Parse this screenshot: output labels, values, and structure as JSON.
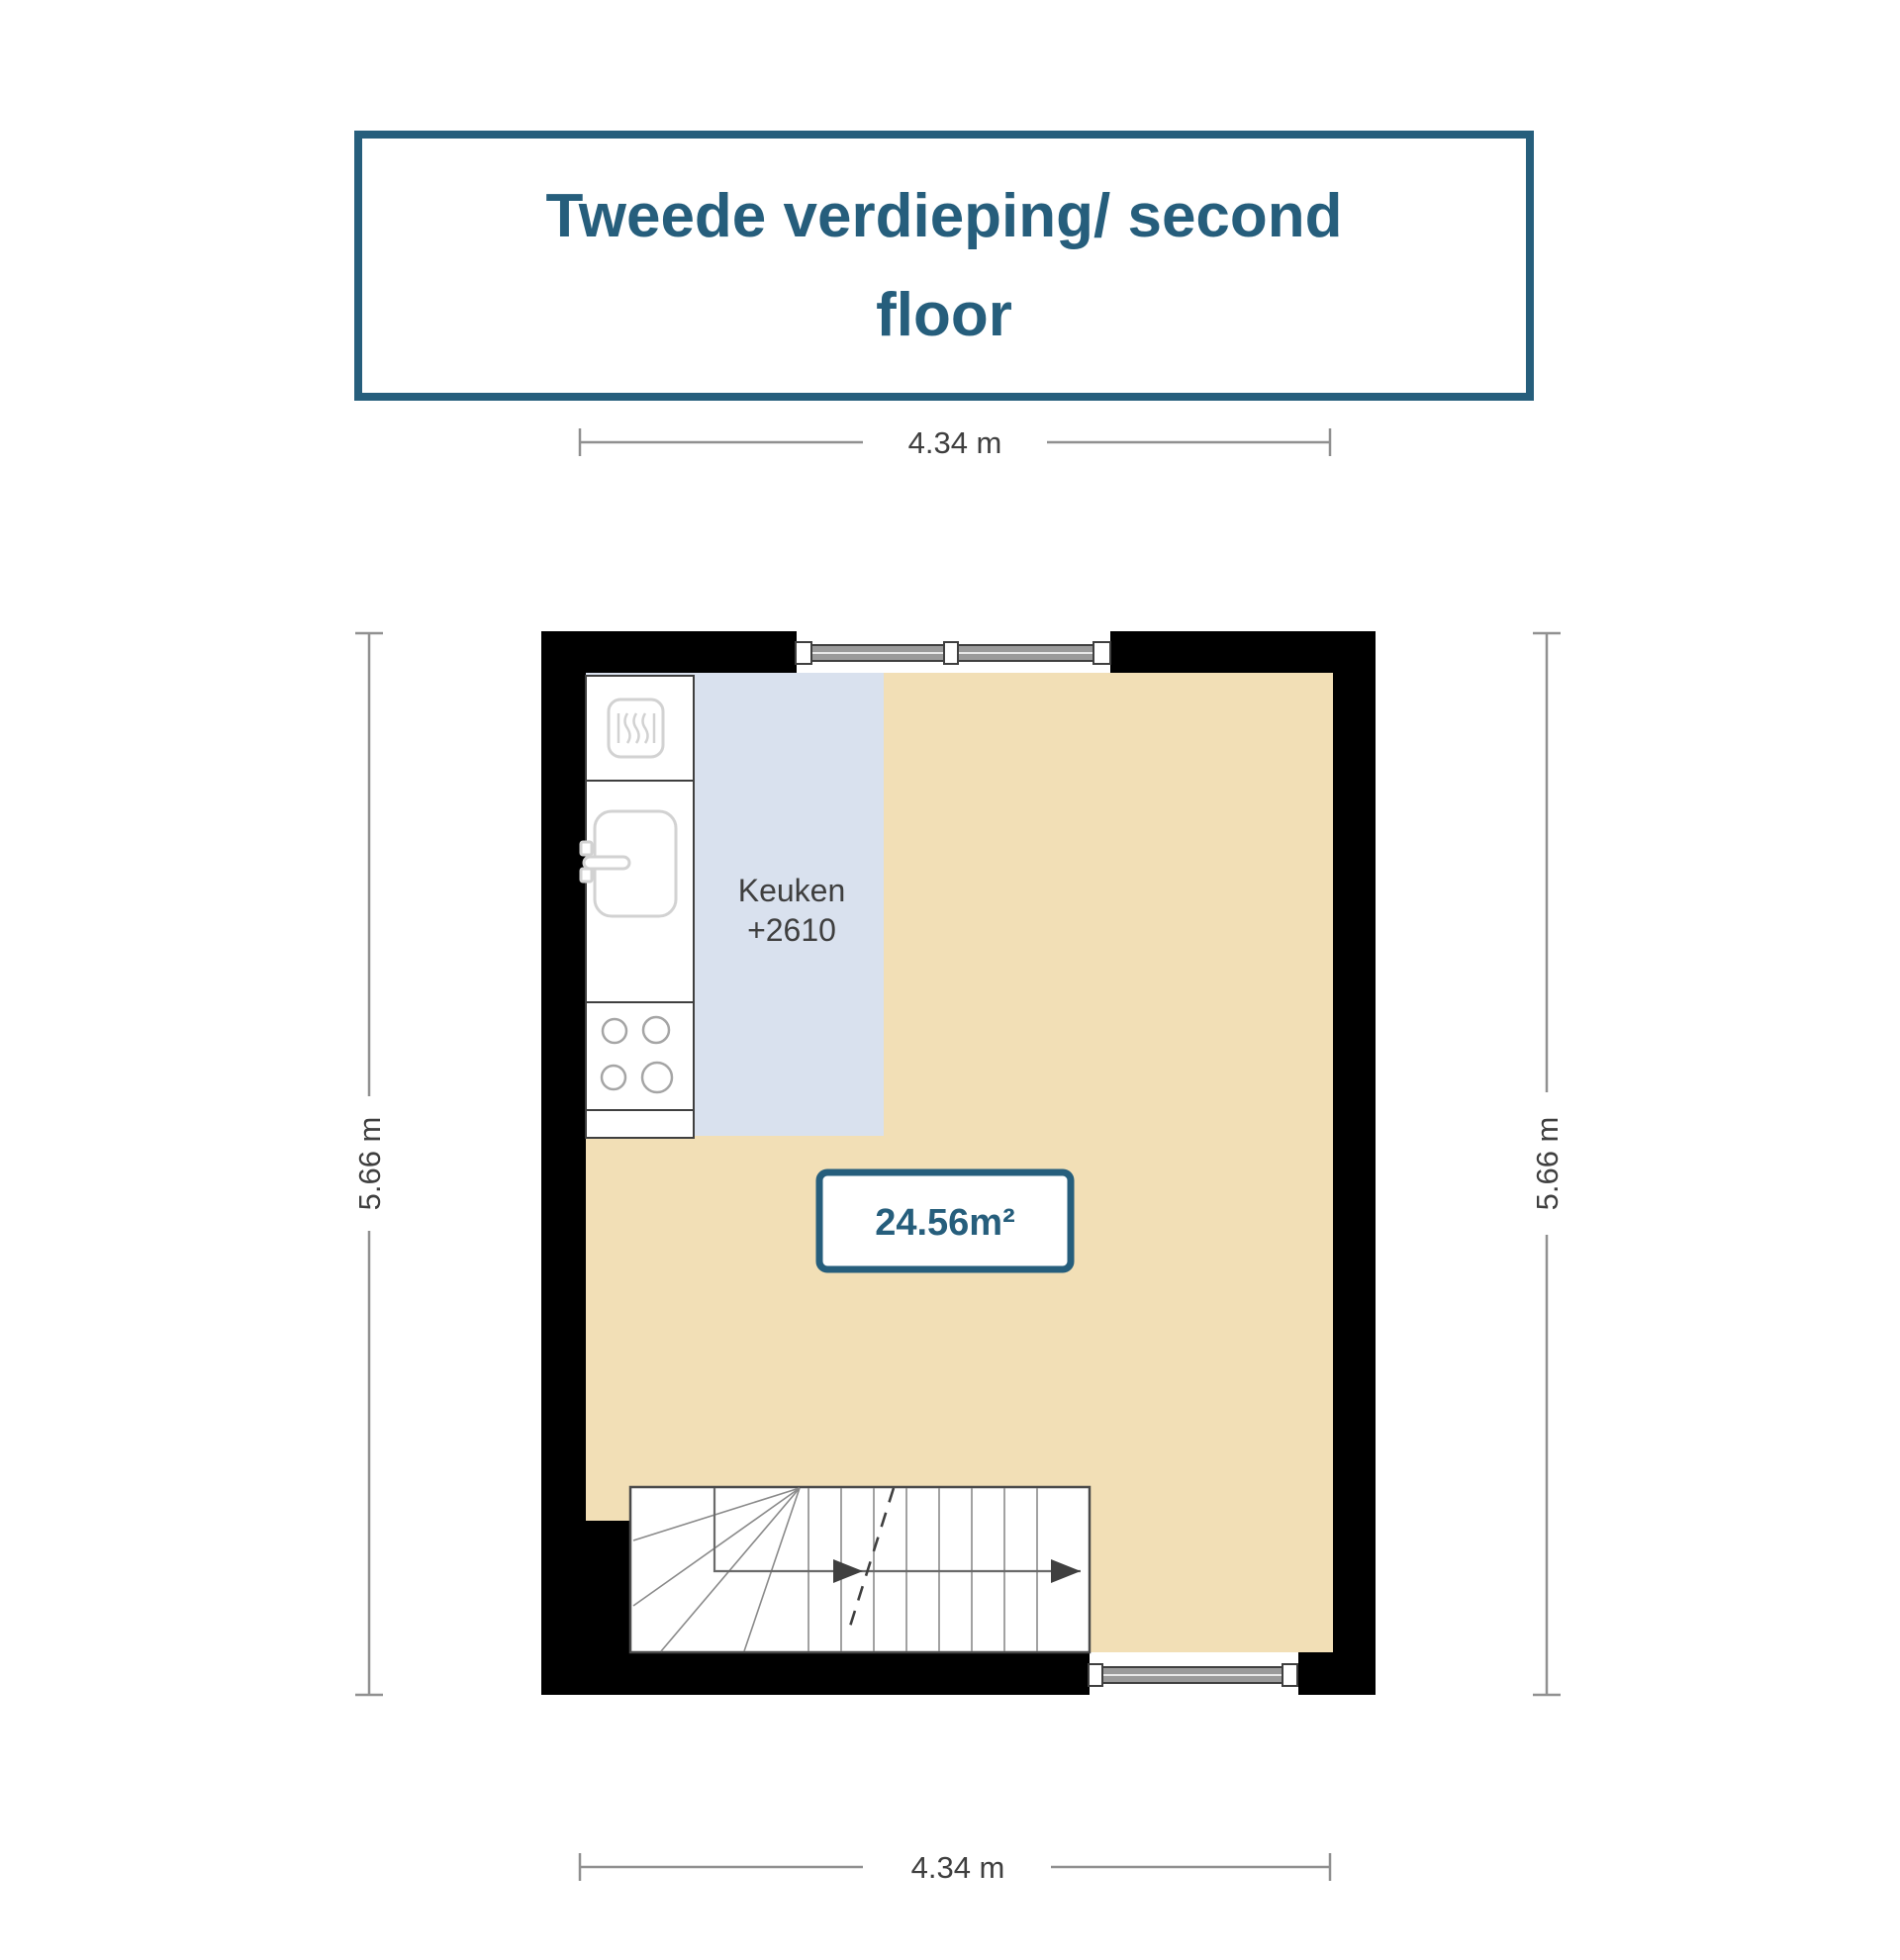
{
  "title": {
    "line1": "Tweede verdieping/ second",
    "line2": "floor"
  },
  "dimensions": {
    "top": "4.34 m",
    "bottom": "4.34 m",
    "left": "5.66 m",
    "right": "5.66 m"
  },
  "room": {
    "name": "Keuken",
    "level_label": "+2610",
    "area_label": "24.56m²"
  },
  "icons": {
    "oven": "oven-icon",
    "sink": "sink-icon",
    "stove": "stove-burners-icon",
    "stairs": "stairs-symbol",
    "window": "window-symbol"
  },
  "colors": {
    "accent_teal": "#265e7c",
    "floor_beige": "#f2dfb6",
    "kitchen_blue": "#d9e1ee",
    "wall_black": "#000000",
    "dimension_gray": "#909090",
    "label_gray": "#3f3f3f"
  }
}
